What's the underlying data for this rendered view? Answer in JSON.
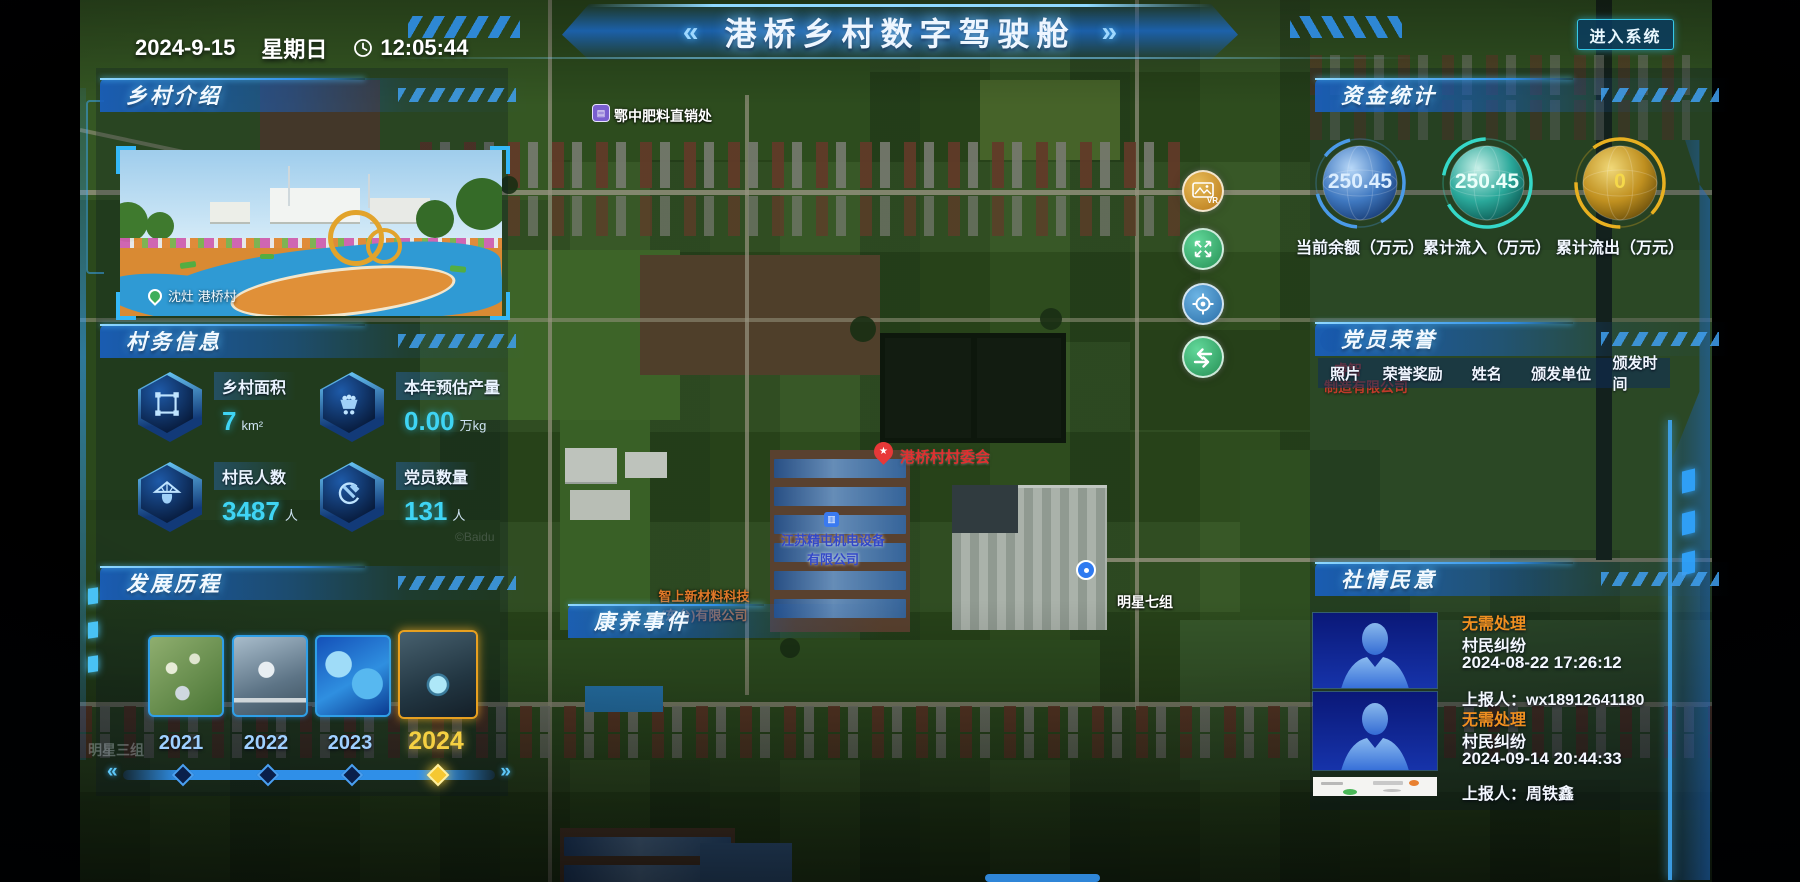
{
  "header": {
    "date": "2024-9-15",
    "weekday": "星期日",
    "time": "12:05:44",
    "title": "港桥乡村数字驾驶舱",
    "chevron_left": "«",
    "chevron_right": "»",
    "enter_button": "进入系统"
  },
  "village_intro": {
    "title": "乡村介绍",
    "photo_caption": "沈灶 港桥村"
  },
  "village_info": {
    "title": "村务信息",
    "stats": [
      {
        "icon": "area-icon",
        "label": "乡村面积",
        "value": "7",
        "unit": "km²"
      },
      {
        "icon": "cart-icon",
        "label": "本年预估产量",
        "value": "0.00",
        "unit": "万kg"
      },
      {
        "icon": "villager-icon",
        "label": "村民人数",
        "value": "3487",
        "unit": "人"
      },
      {
        "icon": "party-icon",
        "label": "党员数量",
        "value": "131",
        "unit": "人"
      }
    ]
  },
  "development": {
    "title": "发展历程",
    "years": [
      "2021",
      "2022",
      "2023",
      "2024"
    ],
    "active_year": "2024",
    "slider_prev": "«",
    "slider_next": "»"
  },
  "funds": {
    "title": "资金统计",
    "gauges": [
      {
        "value": "250.45",
        "label": "当前余额（万元）",
        "color": "#4a9ae8"
      },
      {
        "value": "250.45",
        "label": "累计流入（万元）",
        "color": "#35d8c8"
      },
      {
        "value": "0",
        "label": "累计流出（万元）",
        "color": "#e8b020"
      }
    ]
  },
  "party_honor": {
    "title": "党员荣誉",
    "columns": [
      "照片",
      "荣誉奖励",
      "姓名",
      "颁发单位",
      "颁发时间"
    ]
  },
  "sentiment": {
    "title": "社情民意",
    "items": [
      {
        "status": "无需处理",
        "type": "村民纠纷",
        "time": "2024-08-22 17:26:12",
        "reporter": "上报人：wx18912641180"
      },
      {
        "status": "无需处理",
        "type": "村民纠纷",
        "time": "2024-09-14 20:44:33",
        "reporter": "上报人：周铁鑫"
      }
    ]
  },
  "map": {
    "event_label": "康养事件",
    "watermark": "©Baidu",
    "pois": {
      "fertilizer": "鄂中肥料直销处",
      "committee": "港桥村村委会",
      "jingtun_1": "江苏精屯机电设备",
      "jingtun_2": "有限公司",
      "zhishang_1": "智上新材料科技",
      "zhishang_2": "(东台)有限公司",
      "mingxing7": "明星七组",
      "mingxing3": "明星三组",
      "ruizhi_1": "睿智",
      "ruizhi_2": "制造有限公司"
    },
    "controls": [
      {
        "name": "vr",
        "label": "VR"
      },
      {
        "name": "expand"
      },
      {
        "name": "locate"
      },
      {
        "name": "switch"
      }
    ]
  }
}
